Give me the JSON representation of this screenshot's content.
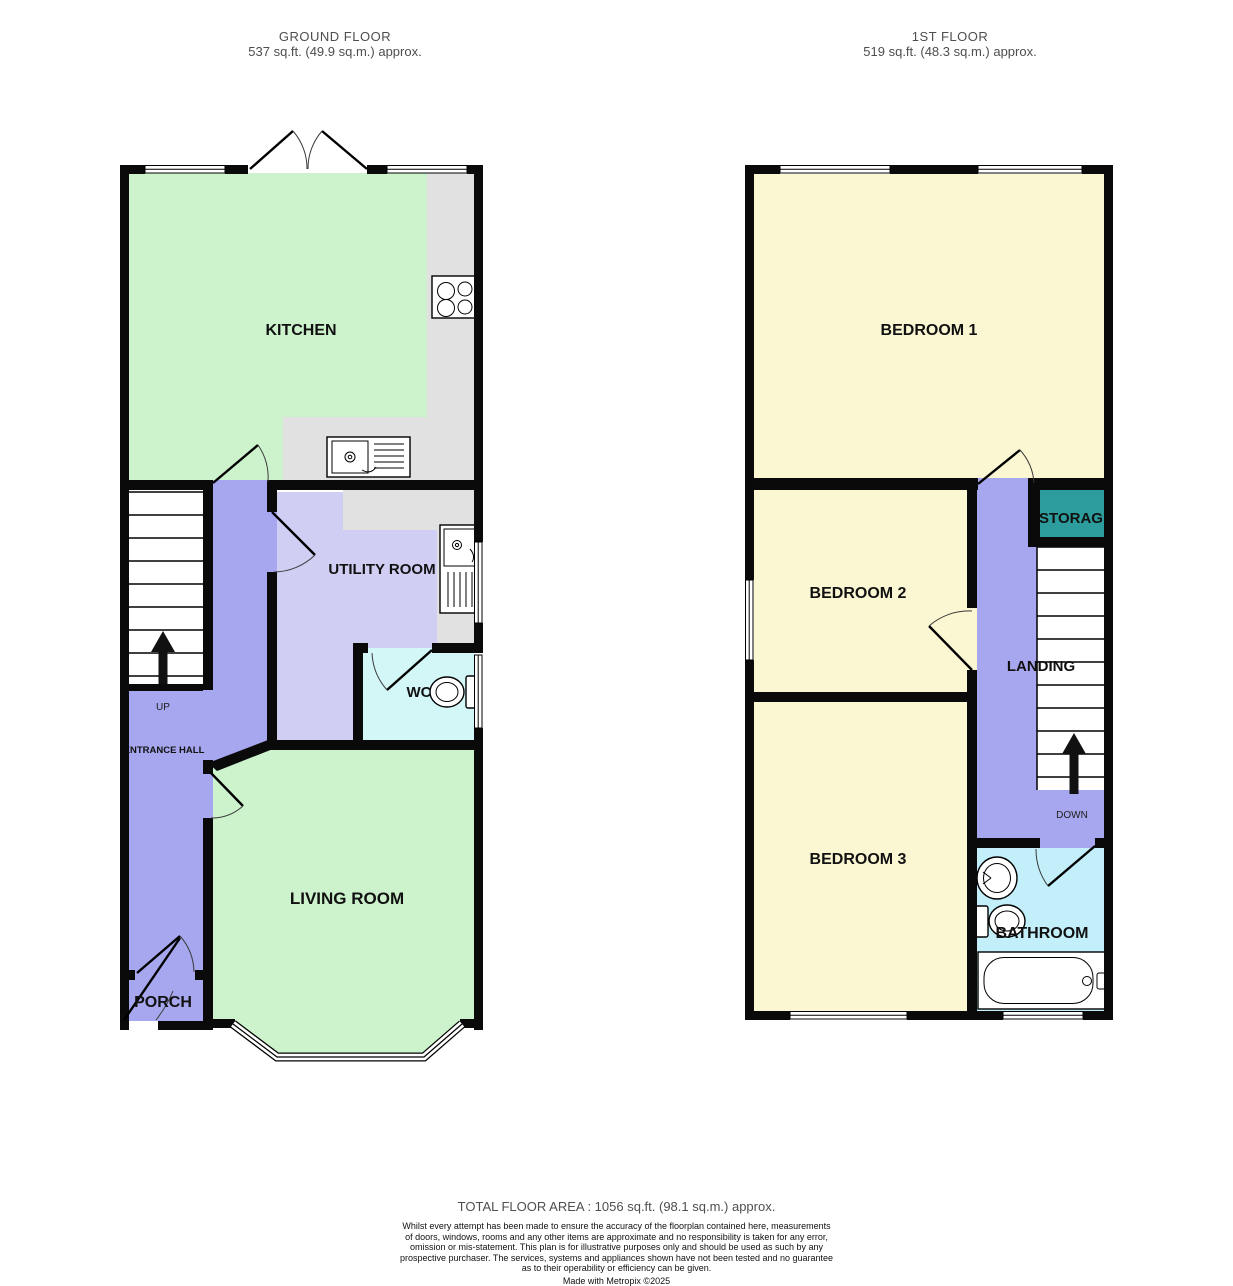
{
  "ground_floor": {
    "title": "GROUND FLOOR",
    "area": "537 sq.ft. (49.9 sq.m.) approx.",
    "rooms": {
      "kitchen": "KITCHEN",
      "utility": "UTILITY ROOM",
      "wc": "WC",
      "living": "LIVING ROOM",
      "porch": "PORCH",
      "entrance_hall": "ENTRANCE HALL"
    },
    "stairs_label": "UP"
  },
  "first_floor": {
    "title": "1ST FLOOR",
    "area": "519 sq.ft. (48.3 sq.m.) approx.",
    "rooms": {
      "bedroom1": "BEDROOM 1",
      "bedroom2": "BEDROOM 2",
      "bedroom3": "BEDROOM 3",
      "storage": "STORAGE",
      "landing": "LANDING",
      "bathroom": "BATHROOM"
    },
    "stairs_label": "DOWN"
  },
  "footer": {
    "total": "TOTAL FLOOR AREA : 1056 sq.ft. (98.1 sq.m.) approx.",
    "disclaimer_lines": [
      "Whilst every attempt has been made to ensure the accuracy of the floorplan contained here, measurements",
      "of doors, windows, rooms and any other items are approximate and no responsibility is taken for any error,",
      "omission or mis-statement. This plan is for illustrative purposes only and should be used as such by any",
      "prospective purchaser. The services, systems and appliances shown have not been tested and no guarantee",
      "as to their operability or efficiency can be given."
    ],
    "credit": "Made with Metropix ©2025"
  },
  "colors": {
    "room-green": "#cdf3cd",
    "room-yellow": "#fbf7d3",
    "hall-purple": "#a7a7ef",
    "utility-lavender": "#d0cef3",
    "wc-cyan": "#d3f6f6",
    "bath-cyan": "#c2effa",
    "storage-teal": "#2d9c9c",
    "counter-grey": "#e1e1e1",
    "wall-black": "#0a0a0a",
    "label-dark": "#111111",
    "header-grey": "#4e4e4e"
  }
}
